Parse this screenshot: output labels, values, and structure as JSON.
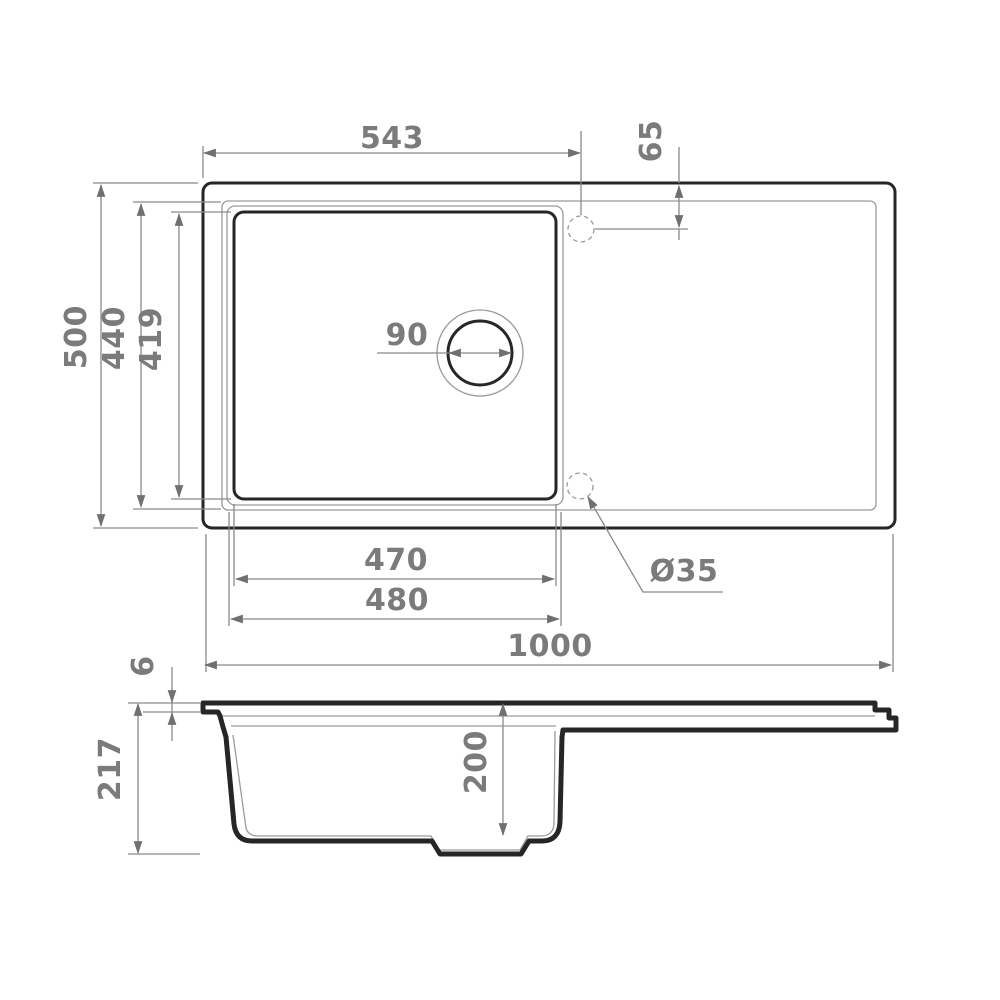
{
  "drawing": {
    "type": "sink technical drawing, top view and section view"
  },
  "top_view": {
    "dim_543": "543",
    "dim_65": "65",
    "dim_500": "500",
    "dim_440": "440",
    "dim_419": "419",
    "dim_90": "90",
    "dim_470": "470",
    "dim_480": "480",
    "dim_1000": "1000",
    "tap_hole_diameter": "Ø35"
  },
  "section_view": {
    "dim_6": "6",
    "dim_217": "217",
    "dim_200": "200"
  },
  "colors": {
    "background": "#ffffff",
    "outline": "#262626",
    "thin_line": "#9a9a9a",
    "dim_line": "#8a8a8a",
    "dim_text": "#7b7b7b",
    "arrow": "#707070"
  }
}
